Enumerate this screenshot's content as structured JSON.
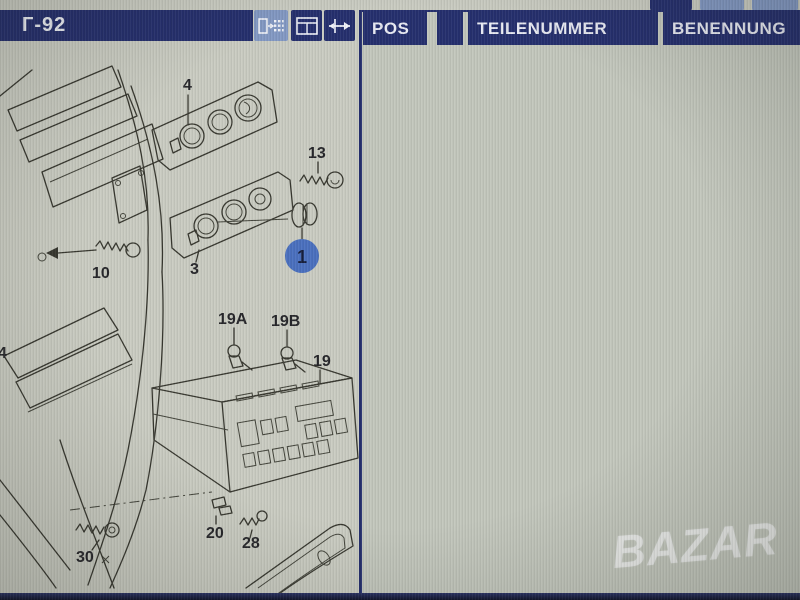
{
  "window": {
    "title": "Г-92"
  },
  "toolbar": {
    "icons": [
      {
        "name": "export-to-table-icon"
      },
      {
        "name": "split-window-icon"
      },
      {
        "name": "resize-columns-icon"
      }
    ],
    "partial_top_buttons": 3
  },
  "colors": {
    "navy": "#252f6e",
    "light_button_blue": "#8399c4",
    "screen_gray": "#c3c7bd",
    "selected_row": "#d9dbd3",
    "arrow_green": "#17a42b",
    "callout_blue": "#4a70bf",
    "watermark_white": "rgba(252,252,255,0.55)"
  },
  "table": {
    "columns": [
      "POS",
      "",
      "TEILENUMMER",
      "BENENNUNG"
    ],
    "rows": [
      {
        "pos": "1",
        "mod": "",
        "num": "4A0 819 041",
        "name": [
          "Drehknopf"
        ],
        "selected": true
      },
      {
        "pos": "",
        "mod": "a",
        "num": "07/92-07/93  01C",
        "name": [
          "satinschwarz"
        ]
      },
      {
        "pos": "(2)",
        "mod": "a",
        "num": "4A0 819 045",
        "name": [
          "Frischluft- und He",
          "regulierung"
        ]
      },
      {
        "pos": "2",
        "mod": "a",
        "num": "4A0 820 045",
        "name": [
          "Frischluft- und Hei",
          "regulierung"
        ]
      },
      {
        "pos": "(3)",
        "mod": "",
        "num": "4A0 819 073  A",
        "name": [
          "Blende fьr Frischlu",
          "Heizungsregulieru"
        ]
      },
      {
        "pos": "",
        "mod": "a",
        "num": "07/92-07/93  01C",
        "name": [
          "satinschwarz"
        ]
      },
      {
        "pos": "3",
        "mod": "",
        "num": "4A0 820 073  A",
        "name": [
          "Blende fьr Frischluf",
          "Heizungsregulierung"
        ]
      },
      {
        "pos": "",
        "mod": "a",
        "num": "07/92-07/93  01C",
        "name": [
          "satinschwarz"
        ]
      },
      {
        "pos": "(4)",
        "mod": "",
        "num": "4A0 819 075  C",
        "name": [
          "Blende fьr Frischluft-",
          "Heizungsregulierung"
        ]
      },
      {
        "pos": "",
        "mod": "a",
        "num": "07/92-07/93  1WV",
        "name": [
          "nussbaum"
        ]
      },
      {
        "pos": "4",
        "mod": "",
        "num": "4A0 820 075  B",
        "name": [
          "Blende fьr Frischluft u",
          "Heizungsregulierung"
        ]
      }
    ]
  },
  "diagram": {
    "highlighted_part": "1",
    "labels": {
      "l4": "4",
      "l13": "13",
      "l3": "3",
      "l1": "1",
      "l10": "10",
      "l19a": "19A",
      "l19b": "19B",
      "l19": "19",
      "l20": "20",
      "l28": "28",
      "l30": "30",
      "l4b": "4"
    }
  },
  "watermark": {
    "text": "BAZAR"
  }
}
